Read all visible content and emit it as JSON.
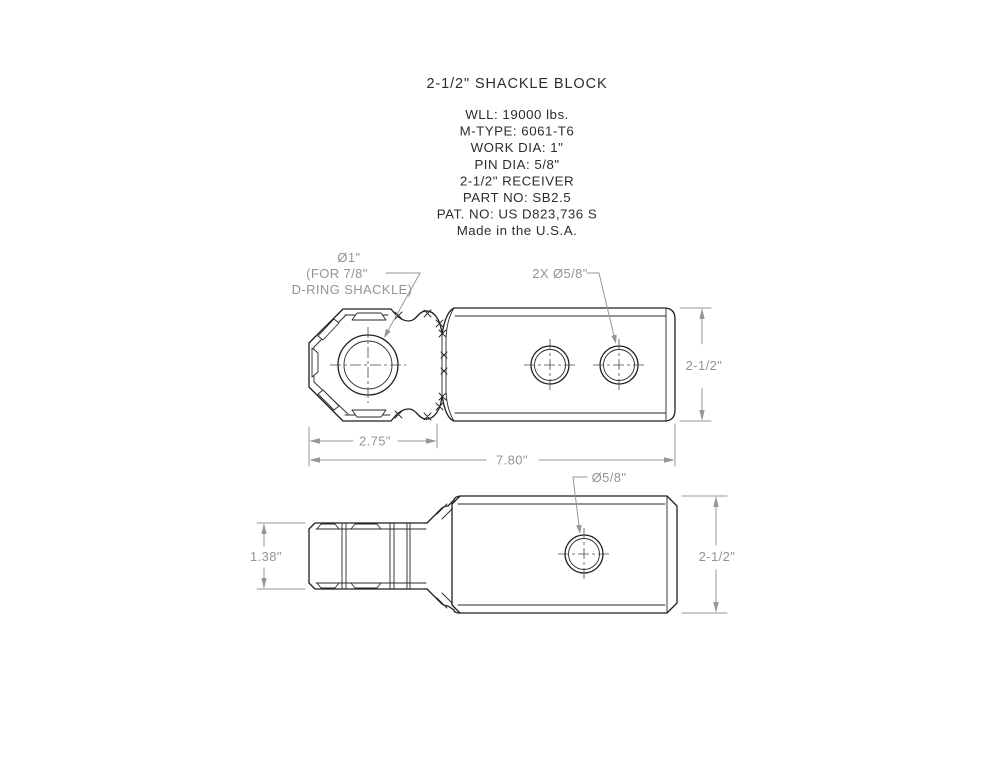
{
  "drawing": {
    "title": "2-1/2\" SHACKLE BLOCK",
    "specs": {
      "lines": [
        "WLL: 19000 lbs.",
        "M-TYPE: 6061-T6",
        "WORK DIA: 1\"",
        "PIN DIA: 5/8\"",
        "2-1/2\" RECEIVER",
        "PART NO: SB2.5",
        "PAT. NO: US D823,736 S",
        "Made in the U.S.A."
      ]
    },
    "top_view": {
      "labels": {
        "main_hole_line1": "Ø1\"",
        "main_hole_line2": "(FOR 7/8\"",
        "main_hole_line3": "D-RING SHACKLE)",
        "pin_holes": "2X Ø5/8\""
      },
      "dimensions": {
        "head_width": "2.75\"",
        "overall_length": "7.80\"",
        "height": "2-1/2\""
      }
    },
    "side_view": {
      "labels": {
        "pin_hole": "Ø5/8\""
      },
      "dimensions": {
        "shank_height": "1.38\"",
        "height": "2-1/2\""
      }
    },
    "colors": {
      "outline": "#1f1f1f",
      "dimension": "#979797",
      "text": "#2d2d2d",
      "background": "#ffffff"
    }
  }
}
